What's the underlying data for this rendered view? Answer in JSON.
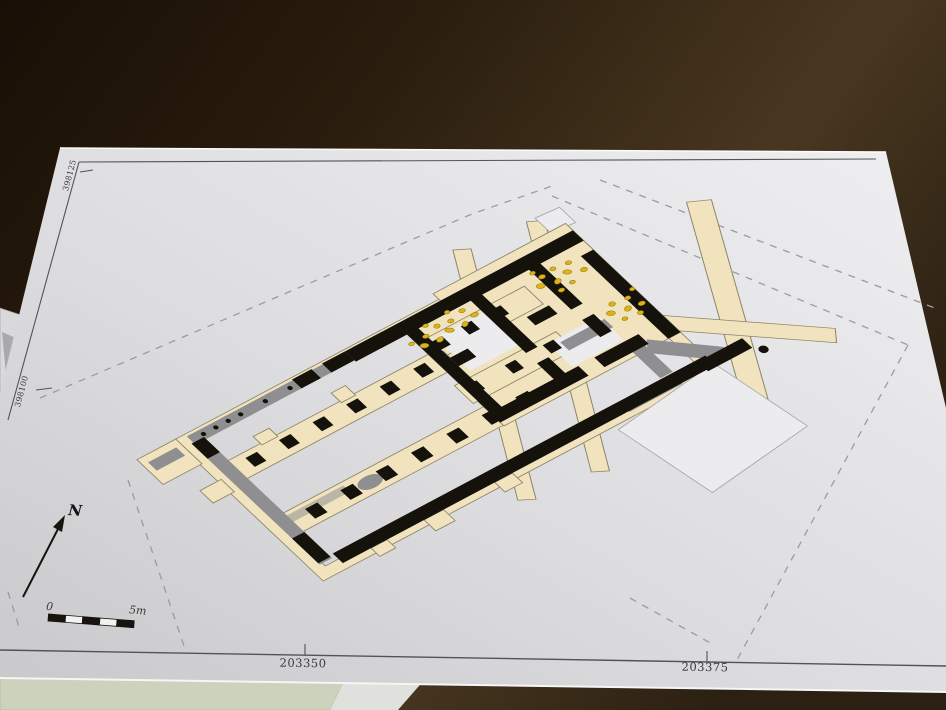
{
  "map": {
    "easting_labels": [
      "203350",
      "203375"
    ],
    "northing_labels": [
      "398100",
      "398125"
    ]
  },
  "compass": {
    "label": "N"
  },
  "scale_bar": {
    "zero_label": "0",
    "end_label": "5m",
    "segments": 5
  },
  "palette": {
    "table_dark": "#20160b",
    "table_light": "#46351d",
    "paper": "#e7e7e9",
    "floor_beige": "#f0e3bd",
    "wall_black": "#15120c",
    "robber_gray": "#8f8f91",
    "rubble_yellow": "#dcb41a",
    "unexcavated_white": "#ececee",
    "dashed_boundary": "#9c9c9c",
    "green_sheet": "#ccd2bb"
  }
}
